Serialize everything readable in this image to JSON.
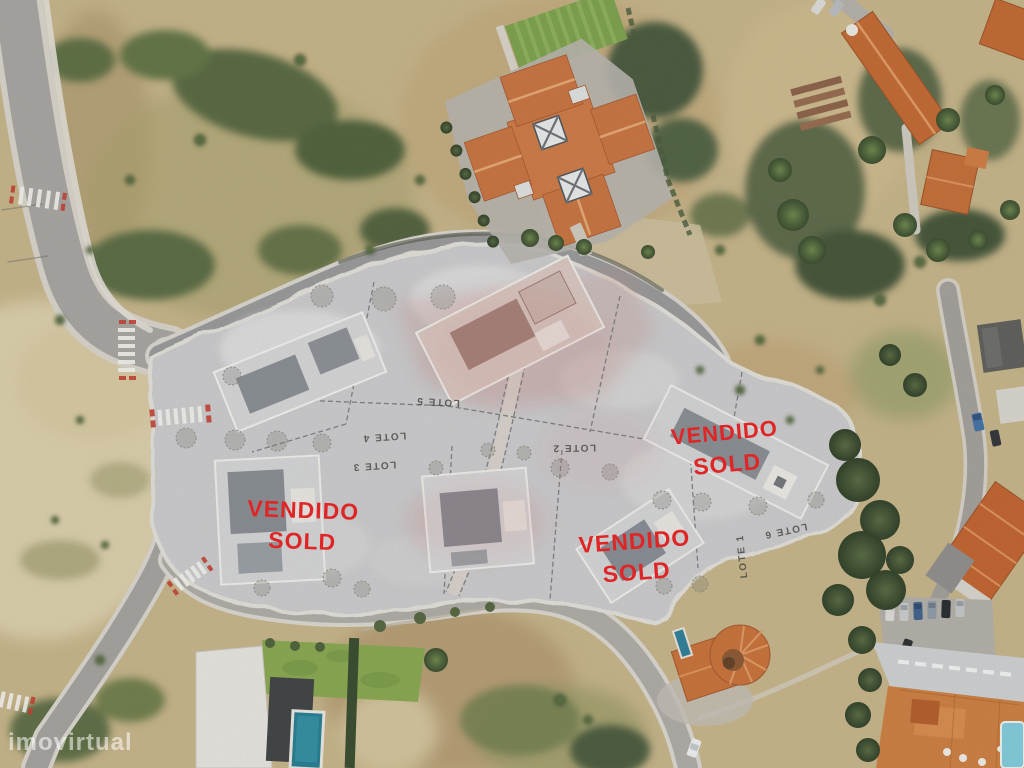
{
  "sold_overlays": [
    {
      "line1": "VENDIDO",
      "line2": "SOLD"
    },
    {
      "line1": "VENDIDO",
      "line2": "SOLD"
    },
    {
      "line1": "VENDIDO",
      "line2": "SOLD"
    }
  ],
  "lot_labels": {
    "lote1": "LOTE 1",
    "lote2": "LOTE 2",
    "lote3": "LOTE 3",
    "lote4": "LOTE 4",
    "lote5": "LOTE 5",
    "lote6": "LOTE 6"
  },
  "watermark": {
    "text": "imovirtual"
  },
  "colors": {
    "sold_text": "#df2526",
    "lot_text": "#4b4b45",
    "watermark_text": "#ffffff",
    "roof_orange": "#c8713d",
    "parcel_gray": "#cbcbce",
    "road_asphalt": "#a6a4a1",
    "vegetation_green": "#4c5f38",
    "scrub_tan": "#c6b488",
    "pool_blue": "#207a90"
  }
}
